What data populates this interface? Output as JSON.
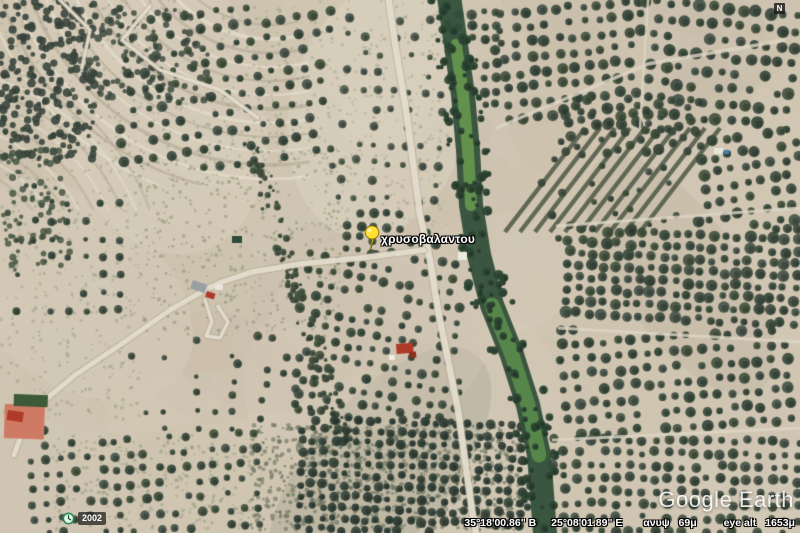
{
  "placemark": {
    "label": "χρυσοβαλαντου",
    "pin_color": "#ffe033"
  },
  "overlay": {
    "imagery_year": "2002",
    "watermark": "Google Earth",
    "north_indicator": "N"
  },
  "status_bar": {
    "latitude": "35°18'00.86\" Β",
    "longitude": "25°08'01.89\" Ε",
    "elevation_label": "ανυψ",
    "elevation": "69μ",
    "eye_alt_label": "eye alt",
    "eye_alt": "1653μ"
  },
  "colors": {
    "pin_yellow": "#ffe033",
    "river_green": "#5d8f4e",
    "tree_green": "#3b4a3e",
    "soil_tan": "#cfc5b1"
  }
}
